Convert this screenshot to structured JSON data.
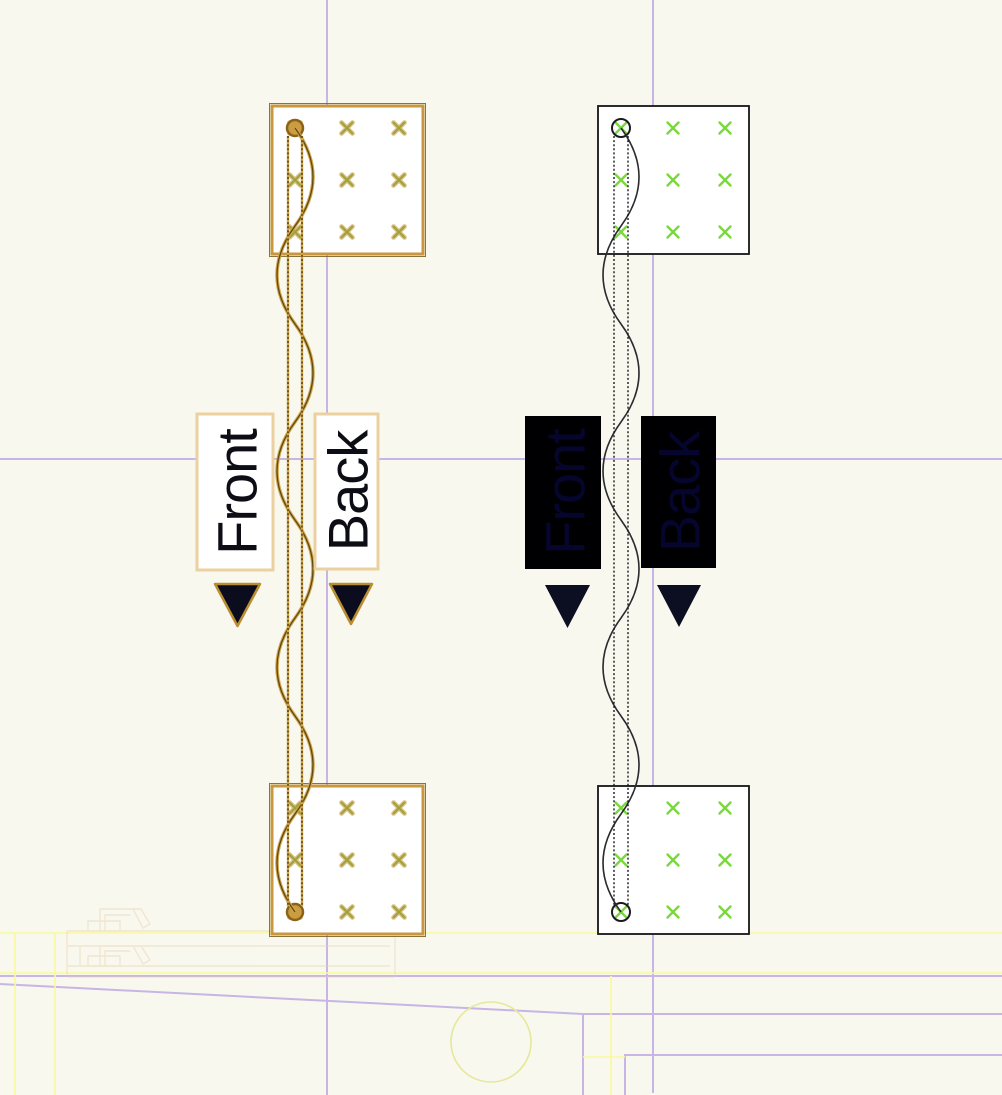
{
  "view": {
    "description_label": "PCB editor canvas",
    "groups": [
      {
        "name": "highlighted-net",
        "front_label": "Front",
        "back_label": "Back"
      },
      {
        "name": "normal-net",
        "front_label": "Front",
        "back_label": "Back"
      }
    ]
  },
  "colors": {
    "background": "#f8f8ee",
    "highlight_tan": "#c9973f",
    "highlight_dark": "#5e4911",
    "outline_black": "#16161a",
    "pad_green": "#79d83c",
    "pad_olive": "#9fa23a",
    "via_gold": "#cb9d40",
    "label_text_dark": "#0d0d15",
    "label_text_on_black": "#05052e",
    "label_fill_black": "#000003",
    "arrow_navy": "#0c0e22",
    "label_border_tan": "#ecd0a0",
    "grid_lavender": "#c7b5e7",
    "grid_yellow": "#fbf99b",
    "circle_khaki": "#e7e79b",
    "fab_tan": "#e9d2ac"
  }
}
